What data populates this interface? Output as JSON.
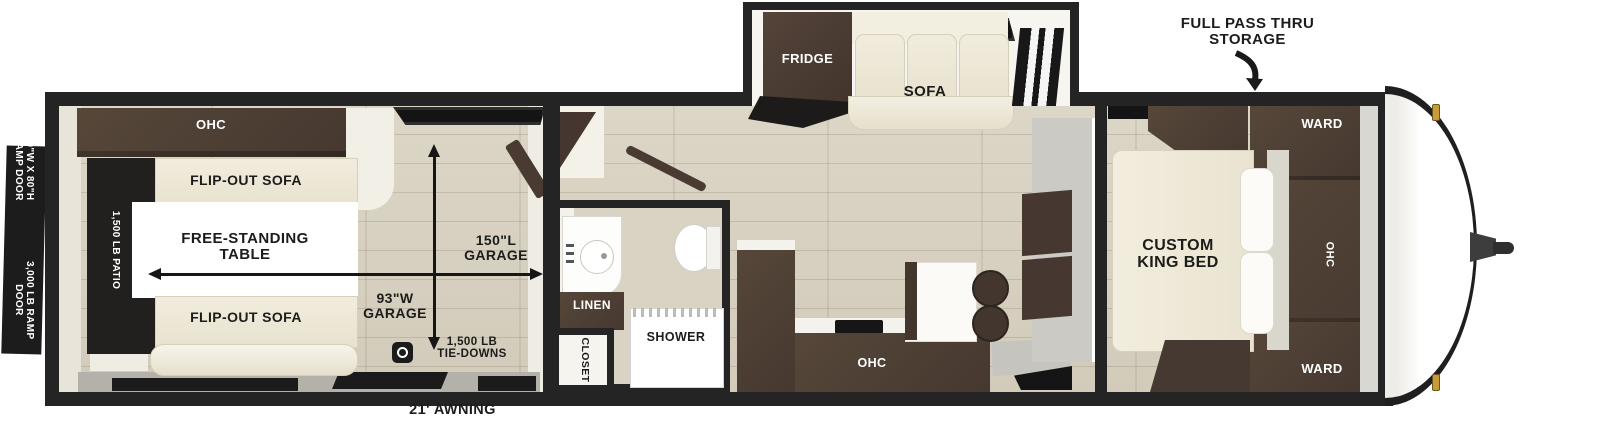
{
  "floorplan": {
    "exterior": {
      "ramp_door": {
        "size_line1": "90\"W X 80\"H",
        "size_line2": "RAMP DOOR",
        "rating_line1": "3,000 LB RAMP",
        "rating_line2": "DOOR"
      },
      "awning": "21' AWNING",
      "pass_thru_line1": "FULL PASS THRU",
      "pass_thru_line2": "STORAGE"
    },
    "garage": {
      "ohc": "OHC",
      "patio": "1,500 LB PATIO",
      "flip_out_sofa_top": "FLIP-OUT SOFA",
      "flip_out_sofa_bottom": "FLIP-OUT SOFA",
      "table_line1": "FREE-STANDING",
      "table_line2": "TABLE",
      "length_line1": "150\"L",
      "length_line2": "GARAGE",
      "width_line1": "93\"W",
      "width_line2": "GARAGE",
      "tie_downs_line1": "1,500 LB",
      "tie_downs_line2": "TIE-DOWNS"
    },
    "bathroom": {
      "linen": "LINEN",
      "shower": "SHOWER",
      "closet": "CLOSET"
    },
    "kitchen": {
      "ohc": "OHC"
    },
    "living": {
      "fridge": "FRIDGE",
      "sofa": "SOFA"
    },
    "bedroom": {
      "bed_line1": "CUSTOM",
      "bed_line2": "KING BED",
      "ohc": "OHC",
      "ward_top": "WARD",
      "ward_bottom": "WARD"
    }
  },
  "colors": {
    "wall": "#242424",
    "floor": "#d8d2c2",
    "cabinet_dark": "#4a3c33",
    "upholstery_cream": "#ece6d5",
    "patio_black": "#211f1e",
    "clearance_light_gold": "#c79b3a"
  }
}
